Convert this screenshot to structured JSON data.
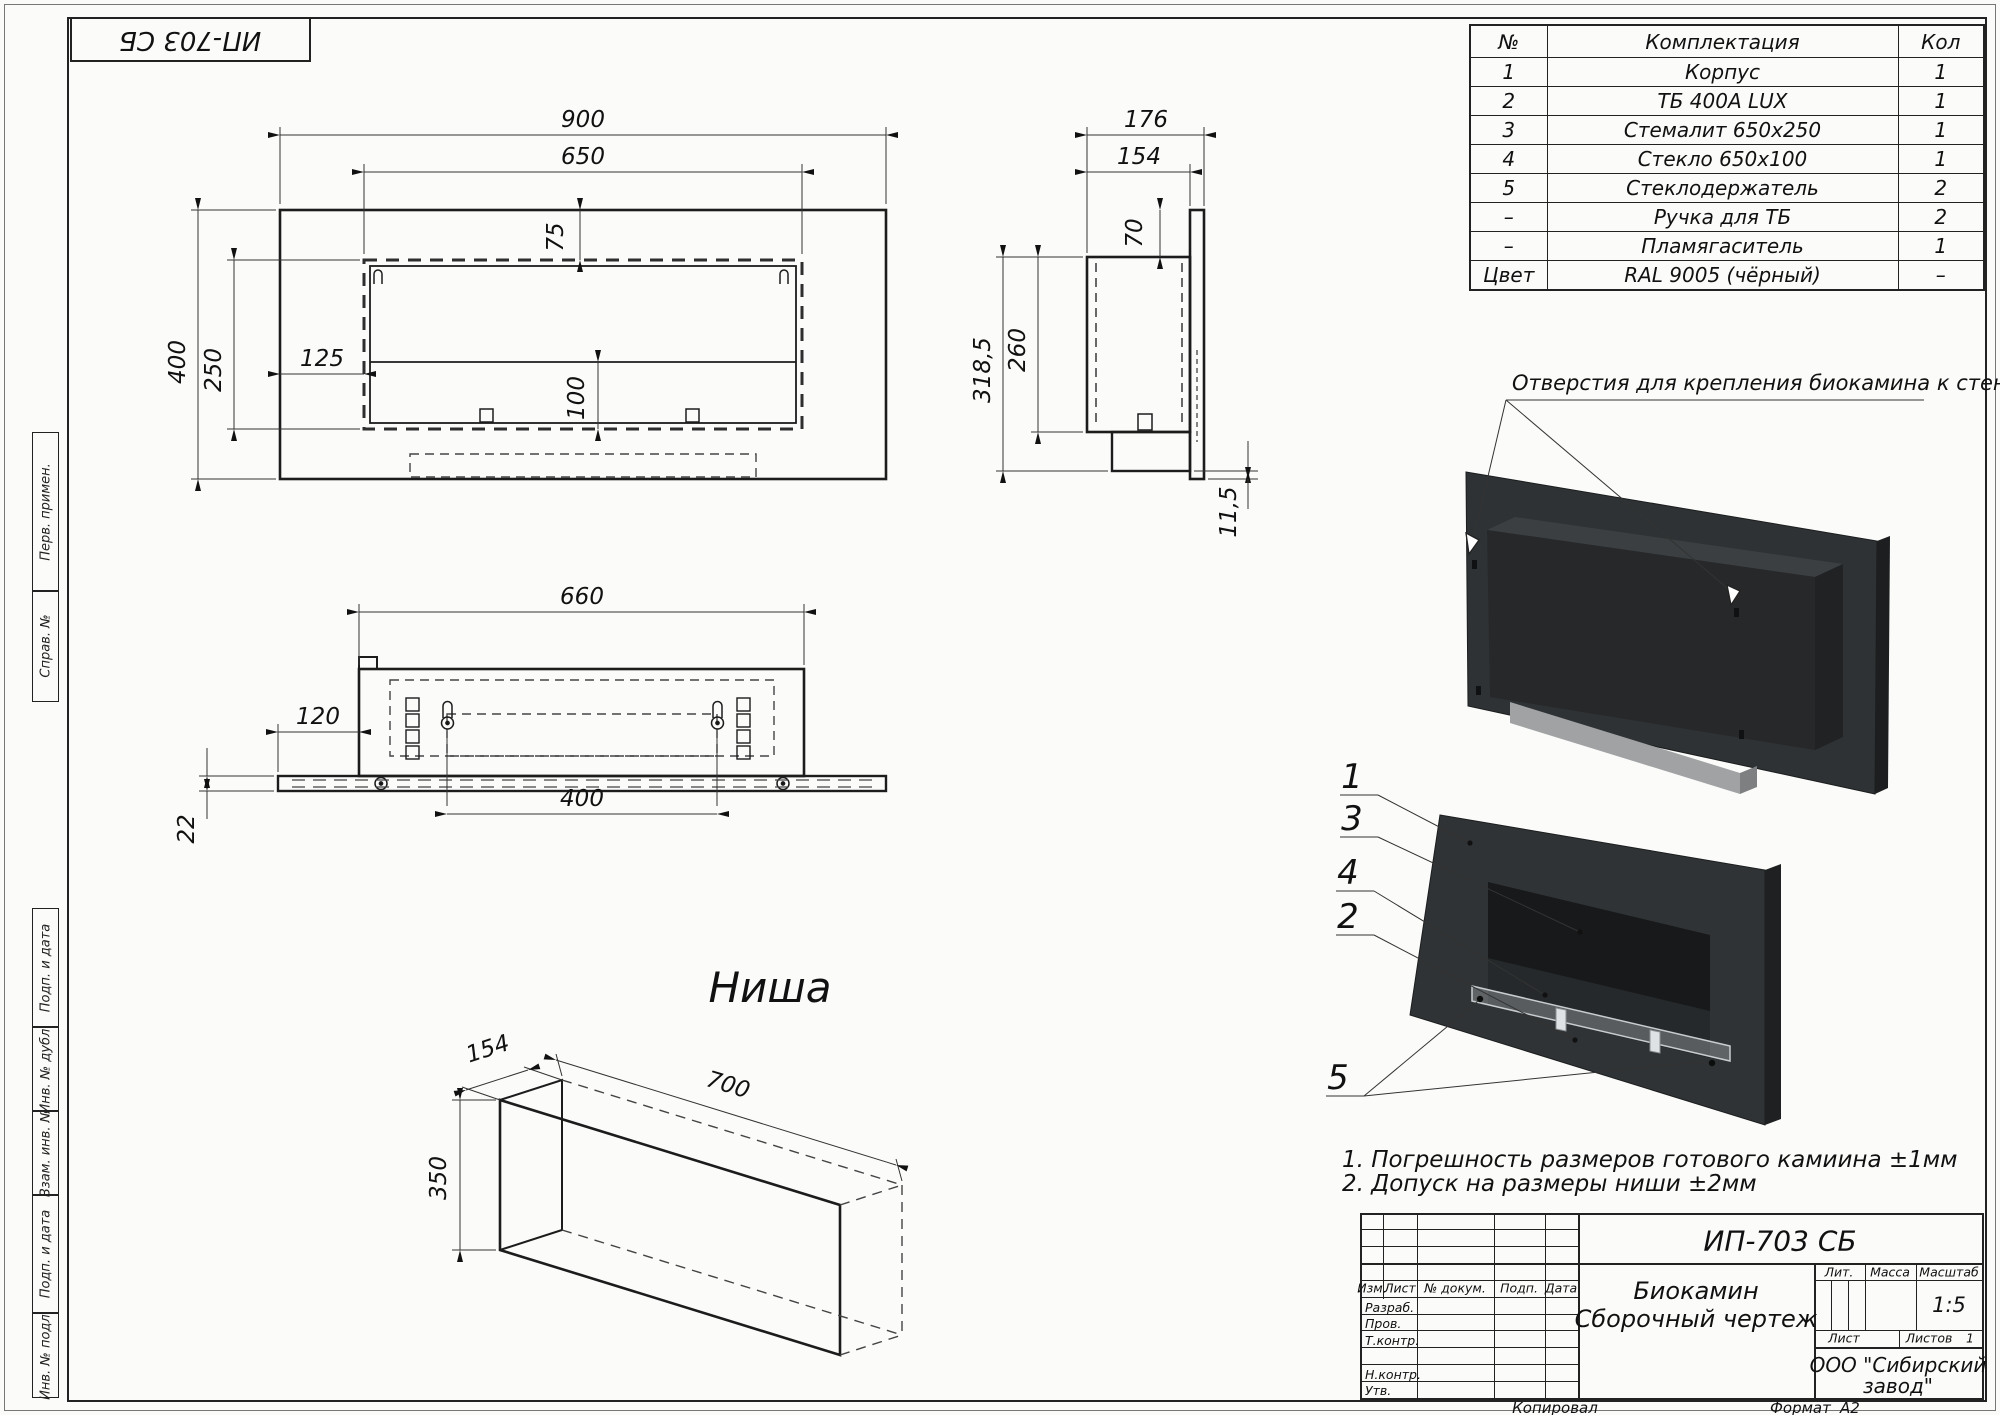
{
  "sheet": {
    "stamp_code": "ИП-703 СБ",
    "copied_label": "Копировал",
    "format_label": "Формат",
    "format_value": "А2"
  },
  "margin_labels": [
    "Перв. примен.",
    "Справ. №",
    "Подп. и дата",
    "Инв. № дубл.",
    "Взам. инв. №",
    "Подп. и дата",
    "Инв. № подл."
  ],
  "parts_table": {
    "headers": [
      "№",
      "Комплектация",
      "Кол"
    ],
    "rows": [
      [
        "1",
        "Корпус",
        "1"
      ],
      [
        "2",
        "ТБ 400А LUX",
        "1"
      ],
      [
        "3",
        "Стемалит 650х250",
        "1"
      ],
      [
        "4",
        "Стекло 650х100",
        "1"
      ],
      [
        "5",
        "Стеклодержатель",
        "2"
      ],
      [
        "–",
        "Ручка для ТБ",
        "2"
      ],
      [
        "–",
        "Пламягаситель",
        "1"
      ],
      [
        "Цвет",
        "RAL 9005 (чёрный)",
        "–"
      ]
    ]
  },
  "views": {
    "front": {
      "width": "900",
      "glass_width": "650",
      "inset_top": "75",
      "inset_left": "125",
      "height": "400",
      "glass_height": "250",
      "burner_height": "100"
    },
    "side": {
      "depth": "176",
      "box_depth": "154",
      "top_offset": "70",
      "box_height": "260",
      "total_height": "318,5",
      "plate_offset": "11,5"
    },
    "bottom": {
      "length": "660",
      "side_offset": "120",
      "plate_thickness": "22",
      "mount_spacing": "400"
    },
    "niche": {
      "label": "Ниша",
      "depth": "154",
      "length": "700",
      "height": "350"
    }
  },
  "renders": {
    "holes_note": "Отверстия для крепления биокамина к стене",
    "callouts": [
      "1",
      "3",
      "4",
      "2",
      "5"
    ]
  },
  "notes": [
    "1. Погрешность размеров готового камиина ±1мм",
    "2. Допуск на размеры ниши ±2мм"
  ],
  "title_block": {
    "designation": "ИП-703 СБ",
    "doc_name_line1": "Биокамин",
    "doc_name_line2": "Сборочный чертеж",
    "lit_label": "Лит.",
    "mass_label": "Масса",
    "scale_label": "Масштаб",
    "scale_value": "1:5",
    "sheet_label": "Лист",
    "sheets_label": "Листов",
    "sheets_value": "1",
    "company_line1": "ООО \"Сибирский",
    "company_line2": "завод\"",
    "header_cols": [
      "Изм.",
      "Лист",
      "№ докум.",
      "Подп.",
      "Дата"
    ],
    "sign_rows": [
      "Разраб.",
      "Пров.",
      "Т.контр.",
      "Н.контр.",
      "Утв."
    ]
  }
}
